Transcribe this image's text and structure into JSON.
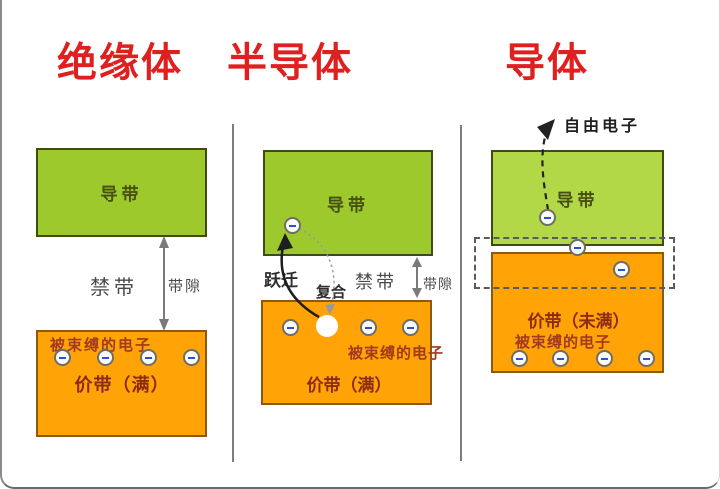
{
  "colors": {
    "title_red": "#e01f1f",
    "green_band": "#9ec92c",
    "green_band_light": "#b2d847",
    "green_border": "#3f4a14",
    "orange_band": "#ffa306",
    "orange_border": "#8a5a12",
    "dark_red_text": "#8b2b15",
    "bound_text_red": "#a03a20",
    "band_label_dark": "#46500f",
    "gray_label": "#4a4a4a",
    "arrow_gray": "#7a7a7a",
    "electron_minus": "#2b4fd0"
  },
  "columns": [
    {
      "title": "绝缘体",
      "conduction_band": "导带",
      "forbidden_band": "禁带",
      "band_gap": "带隙",
      "bound_electrons": "被束缚的电子",
      "valence_band": "价带（满）"
    },
    {
      "title": "半导体",
      "conduction_band": "导带",
      "transition": "跃迁",
      "recombination": "复合",
      "forbidden_band": "禁带",
      "band_gap": "带隙",
      "bound_electrons": "被束缚的电子",
      "valence_band": "价带（满）"
    },
    {
      "title": "导体",
      "free_electron": "自由电子",
      "conduction_band": "导带",
      "valence_band": "价带（未满）",
      "bound_electrons": "被束缚的电子"
    }
  ]
}
